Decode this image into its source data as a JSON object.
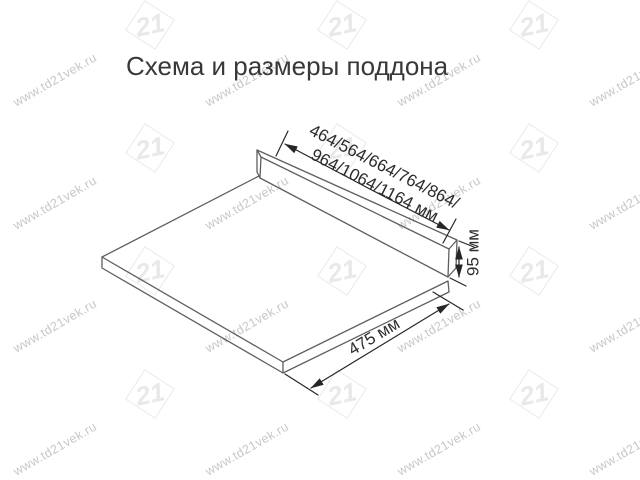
{
  "page": {
    "title": "Схема и размеры поддона"
  },
  "diagram": {
    "description": "isometric line drawing of a drawer pallet (flat panel with back rail)",
    "dimension_labels": {
      "width_line1": "464/564/664/764/864/",
      "width_line2": "964/1064/1164 мм",
      "height": "95 мм",
      "depth": "475 мм"
    },
    "colors": {
      "outline": "#5f5f5f",
      "dimension": "#262626",
      "title_text": "#383838"
    }
  },
  "watermark": {
    "text": "www.td21vek.ru",
    "logo_text": "21",
    "text_color": "#c7c7c7",
    "logo_color": "#e9e9e9"
  }
}
